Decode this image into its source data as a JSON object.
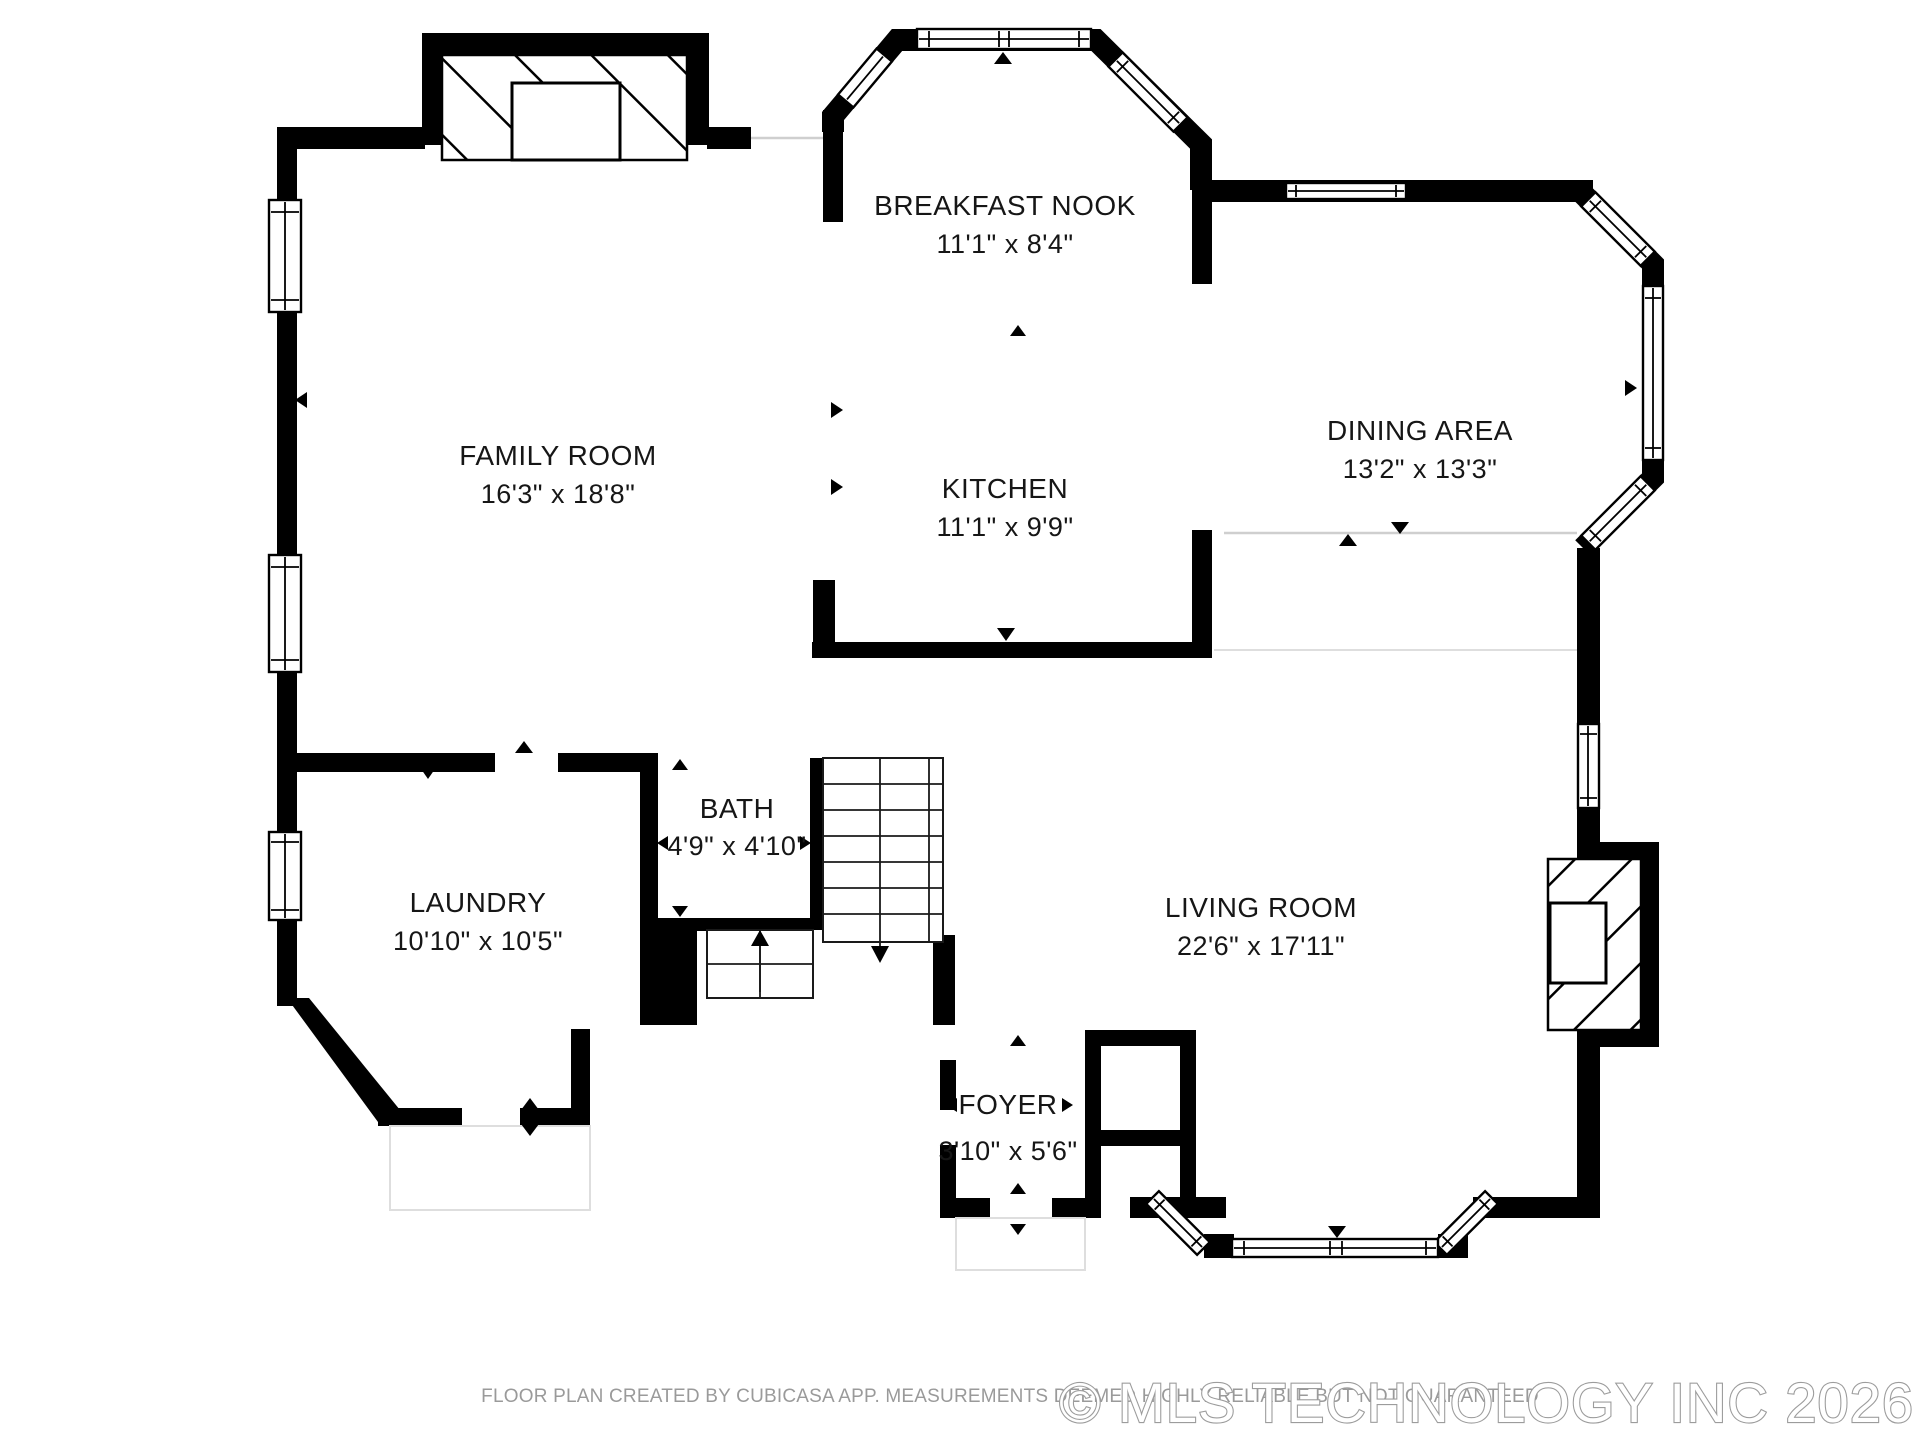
{
  "rooms": {
    "breakfast_nook": {
      "name": "BREAKFAST NOOK",
      "dims": "11'1\" x 8'4\""
    },
    "family_room": {
      "name": "FAMILY ROOM",
      "dims": "16'3\" x 18'8\""
    },
    "kitchen": {
      "name": "KITCHEN",
      "dims": "11'1\" x 9'9\""
    },
    "dining_area": {
      "name": "DINING AREA",
      "dims": "13'2\" x 13'3\""
    },
    "bath": {
      "name": "BATH",
      "dims": "4'9\" x 4'10\""
    },
    "laundry": {
      "name": "LAUNDRY",
      "dims": "10'10\" x 10'5\""
    },
    "living_room": {
      "name": "LIVING ROOM",
      "dims": "22'6\" x 17'11\""
    },
    "foyer": {
      "name": "FOYER",
      "dims": "3'10\" x 5'6\""
    }
  },
  "footer": {
    "disclaimer": "FLOOR PLAN CREATED BY CUBICASA APP. MEASUREMENTS DEEMED HIGHLY RELIABLE BUT NOT GUARANTEED",
    "watermark": "© MLS TECHNOLOGY INC 2026"
  },
  "colors": {
    "wall": "#000000",
    "label": "#161616",
    "disclaimer": "#9a9a9a",
    "watermark": "#9c9c9c"
  }
}
